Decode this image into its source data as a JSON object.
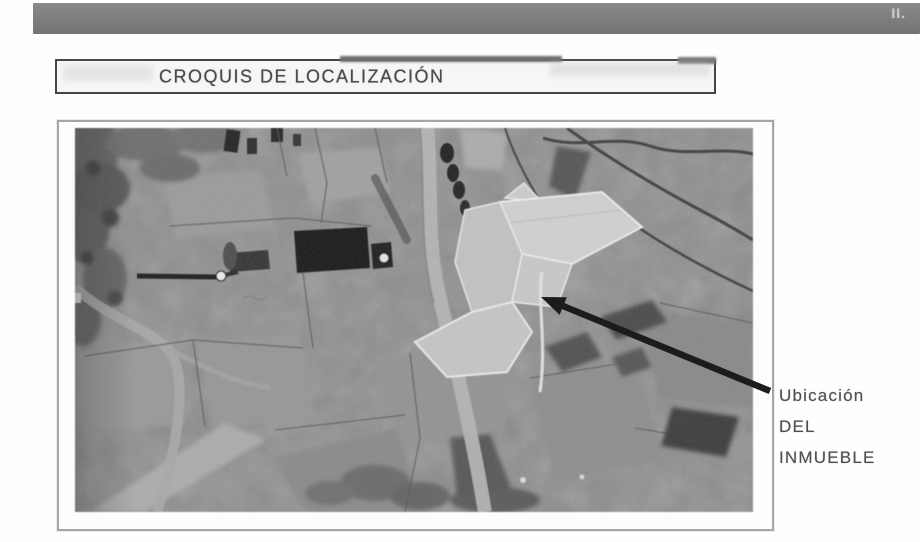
{
  "header": {
    "mark": "II."
  },
  "title_box": {
    "label": "CROQUIS DE LOCALIZACIÓN"
  },
  "map": {
    "annotation": {
      "line1": "Ubicación",
      "line2": "DEL",
      "line3": "INMUEBLE"
    }
  },
  "colors": {
    "header_bar": "#7d7d7d",
    "title_text": "#4a4a4a",
    "annotation_text": "#4d4d4d",
    "arrow": "#1c1c1c",
    "photo_base": "#8d8d8d",
    "property_highlight": "#d3d3d3"
  }
}
